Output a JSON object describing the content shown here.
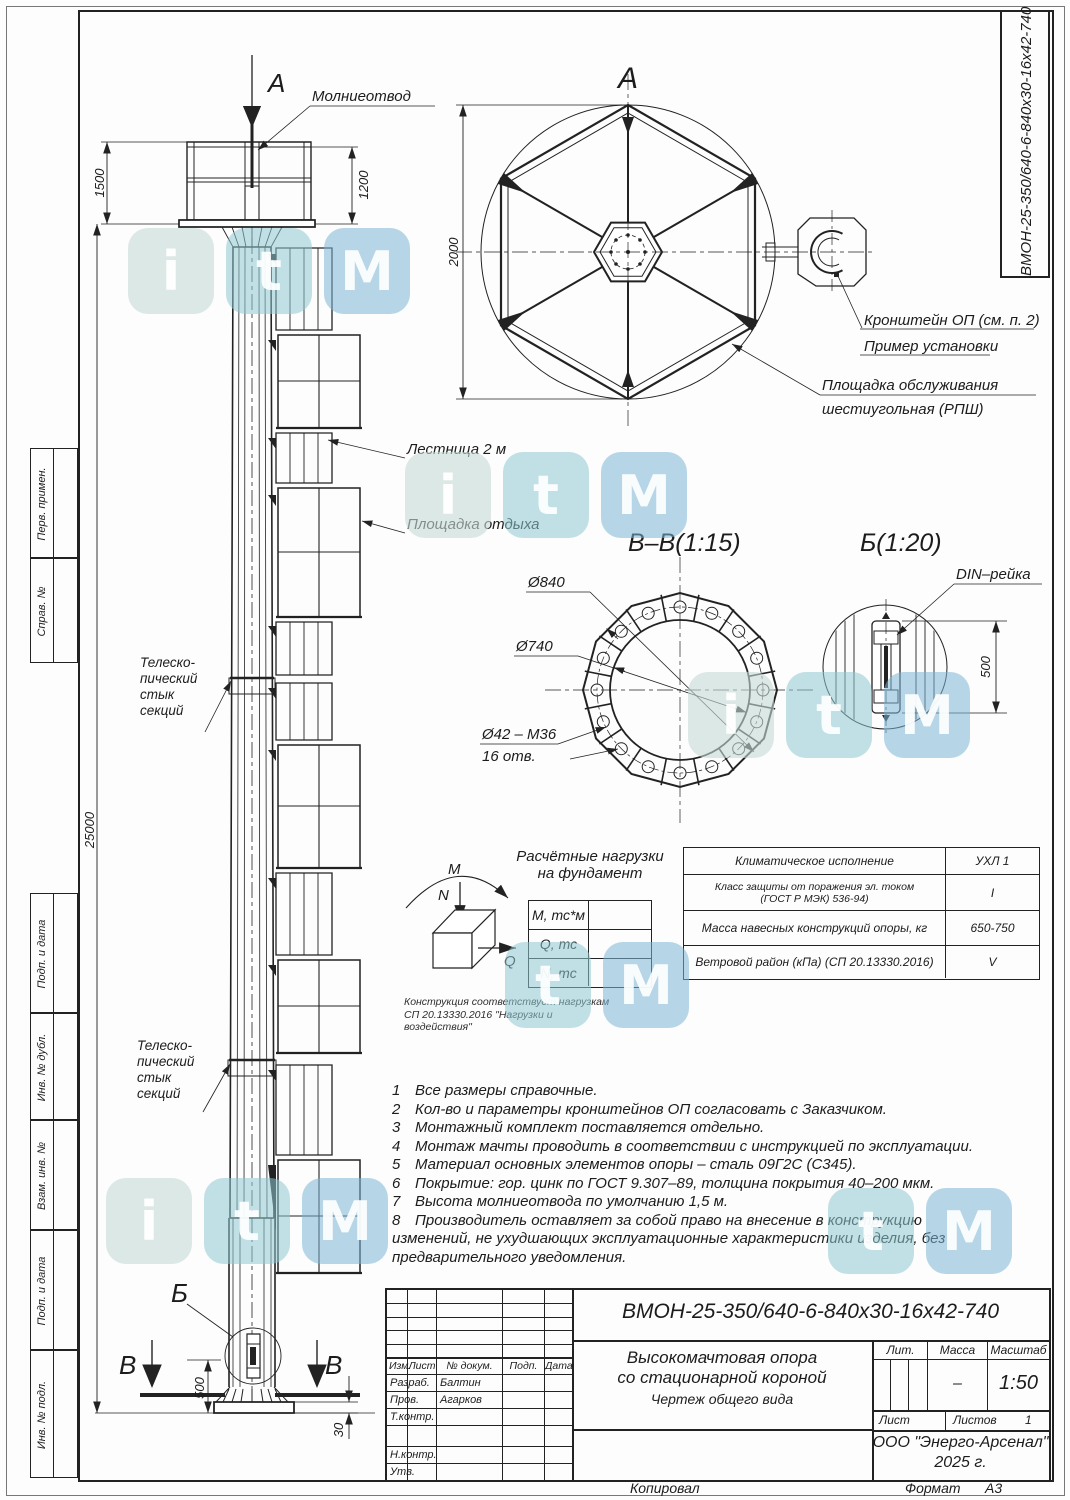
{
  "frame": {
    "kopiroval": "Копировал",
    "format_label": "Формат",
    "format_value": "А3",
    "doc_number_vertical": "ВМОН-25-350/640-6-840х30-16х42-740",
    "left_stamps": [
      "Перв. примен.",
      "Справ. №",
      "Подп. и дата",
      "Инв. № дубл.",
      "Взам. инв. №",
      "Подп. и дата",
      "Инв. № подл."
    ]
  },
  "watermark": {
    "letters": [
      "i",
      "t",
      "M"
    ]
  },
  "mast": {
    "section_arrow": "А",
    "lightning_rod": "Молниеотвод",
    "ladder": "Лестница 2 м",
    "rest_platform": "Площадка отдыха",
    "telescopic_joint": "Телеско-\nпический\nстык\nсекций",
    "detail_b": "Б",
    "section_v": "В",
    "dim_crown_height": "1500",
    "dim_cage_height": "1200",
    "dim_total": "25000",
    "dim_base_500": "500",
    "dim_base_30": "30"
  },
  "view_a": {
    "title": "А",
    "dim": "2000",
    "bracket_line1": "Кронштейн ОП (см. п. 2)",
    "bracket_line2": "Пример установки",
    "platform_line1": "Площадка обслуживания",
    "platform_line2": "шестиугольная (РПШ)"
  },
  "view_vv": {
    "title": "В–В(1:15)",
    "d840": "Ø840",
    "d740": "Ø740",
    "bolts1": "Ø42 – М36",
    "bolts2": "16 отв."
  },
  "view_b": {
    "title": "Б(1:20)",
    "din": "DIN–рейка",
    "dim": "500"
  },
  "loads": {
    "title1": "Расчётные нагрузки",
    "title2": "на фундамент",
    "m": "М",
    "n": "N",
    "q": "Q",
    "rows": [
      {
        "label": "М, тс*м",
        "value": ""
      },
      {
        "label": "Q, тс",
        "value": ""
      },
      {
        "label": "N, тс",
        "value": ""
      }
    ],
    "note1": "Конструкция соответствует нагрузкам",
    "note2": "СП 20.13330.2016 \"Нагрузки и воздействия\""
  },
  "climate": {
    "rows": [
      {
        "label": "Климатическое исполнение",
        "value": "УХЛ 1"
      },
      {
        "label": "Класс защиты от поражения эл. током\n(ГОСТ Р МЭК) 536-94)",
        "value": "I"
      },
      {
        "label": "Масса навесных конструкций опоры, кг",
        "value": "650-750"
      },
      {
        "label": "Ветровой район (кПа) (СП 20.13330.2016)",
        "value": "V"
      }
    ]
  },
  "notes": {
    "items": [
      {
        "num": "1",
        "text": "Все размеры справочные."
      },
      {
        "num": "2",
        "text": "Кол-во и параметры кронштейнов ОП согласовать с Заказчиком."
      },
      {
        "num": "3",
        "text": "Монтажный комплект поставляется отдельно."
      },
      {
        "num": "4",
        "text": "Монтаж мачты проводить в соответствии с инструкцией по эксплуатации."
      },
      {
        "num": "5",
        "text": "Материал основных элементов опоры – сталь 09Г2С (С345)."
      },
      {
        "num": "6",
        "text": "Покрытие: гор. цинк по ГОСТ 9.307–89, толщина покрытия 40–200 мкм."
      },
      {
        "num": "7",
        "text": "Высота молниеотвода по умолчанию 1,5 м."
      },
      {
        "num": "8",
        "text": "Производитель оставляет за собой право на внесение в конструкцию изменений, не ухудшающих эксплуатационные характеристики изделия, без предварительного уведомления."
      }
    ]
  },
  "titleblock": {
    "doc_number": "ВМОН-25-350/640-6-840х30-16х42-740",
    "title_line1": "Высокомачтовая опора",
    "title_line2": "со стационарной короной",
    "title_line3": "Чертеж общего вида",
    "cols": {
      "izm": "Изм.",
      "list": "Лист",
      "doc": "№ докум.",
      "podp": "Подп.",
      "data": "Дата"
    },
    "rows": [
      {
        "label": "Разраб.",
        "name": "Балтин"
      },
      {
        "label": "Пров.",
        "name": "Агарков"
      },
      {
        "label": "Т.контр.",
        "name": ""
      },
      {
        "label": "Н.контр.",
        "name": ""
      },
      {
        "label": "Утв.",
        "name": ""
      }
    ],
    "lit_label": "Лит.",
    "mass_label": "Масса",
    "scale_label": "Масштаб",
    "mass_value": "–",
    "scale_value": "1:50",
    "sheet_label": "Лист",
    "sheets_label": "Листов",
    "sheets_value": "1",
    "org_line1": "ООО \"Энерго-Арсенал\"",
    "org_line2": "2025 г."
  }
}
